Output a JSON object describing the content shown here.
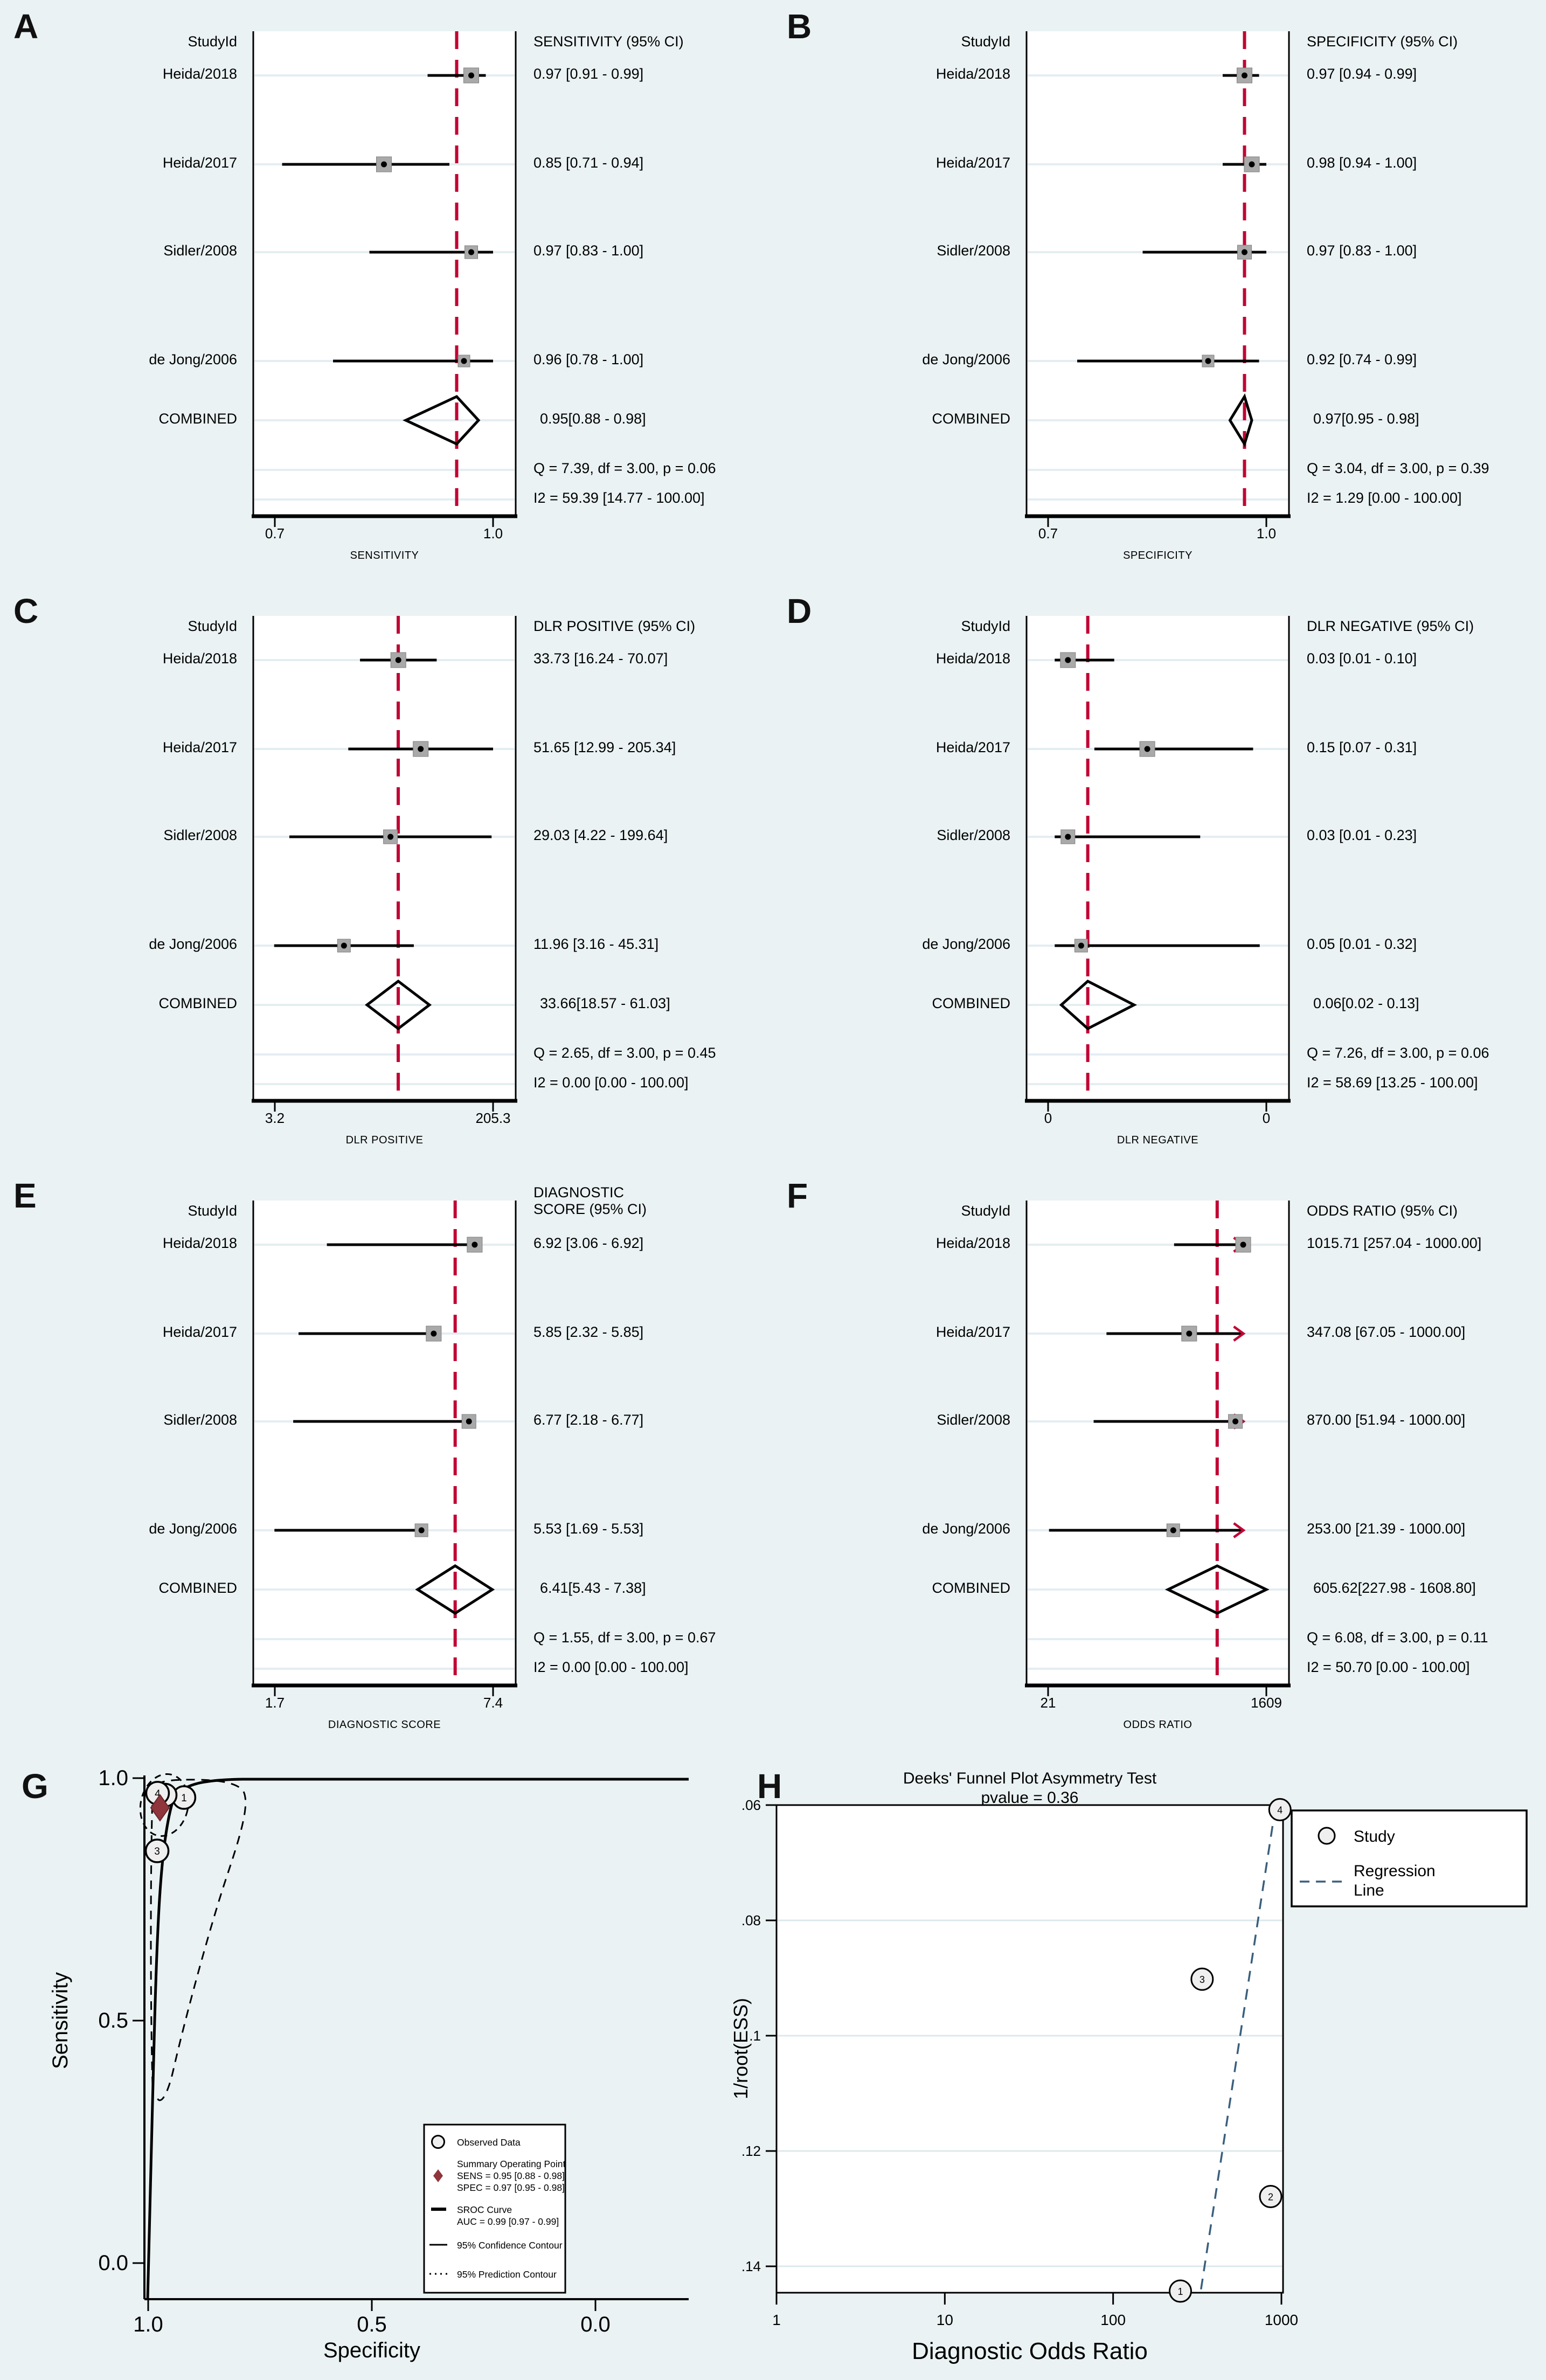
{
  "figure": {
    "background": "#eaf2f3",
    "plot_bg": "#ffffff",
    "ref_line_color": "#c10534",
    "marker_fill": "#a9a9a9",
    "marker_dot": "#000000",
    "diamond_stroke": "#000000",
    "summary_point_color": "#8f353b",
    "regression_color": "#3a5f7d",
    "grid_color": "#e4edf2"
  },
  "chart_data": [
    {
      "type": "forest",
      "letter": "A",
      "col_header": "StudyId",
      "value_header": "SENSITIVITY (95% CI)",
      "scale": "linear",
      "axis_lo": 0.7,
      "axis_hi": 1.0,
      "tick_lo_label": "0.7",
      "tick_hi_label": "1.0",
      "axis_title": "SENSITIVITY",
      "ref": 0.95,
      "arrows": false,
      "studies": [
        {
          "label": "Heida/2018",
          "text": "0.97 [0.91 - 0.99]",
          "est": 0.97,
          "lo": 0.91,
          "hi": 0.99,
          "w": 28
        },
        {
          "label": "Heida/2017",
          "text": "0.85 [0.71 - 0.94]",
          "est": 0.85,
          "lo": 0.71,
          "hi": 0.94,
          "w": 28
        },
        {
          "label": "Sidler/2008",
          "text": "0.97 [0.83 - 1.00]",
          "est": 0.97,
          "lo": 0.83,
          "hi": 1.0,
          "w": 24
        },
        {
          "label": "de Jong/2006",
          "text": "0.96 [0.78 - 1.00]",
          "est": 0.96,
          "lo": 0.78,
          "hi": 1.0,
          "w": 22
        }
      ],
      "combined": {
        "label": "COMBINED",
        "text": "0.95[0.88 - 0.98]",
        "est": 0.95,
        "lo": 0.88,
        "hi": 0.98
      },
      "q_text": "Q =  7.39, df = 3.00, p =  0.06",
      "i2_text": "I2 = 59.39 [14.77 - 100.00]"
    },
    {
      "type": "forest",
      "letter": "B",
      "col_header": "StudyId",
      "value_header": "SPECIFICITY (95% CI)",
      "scale": "linear",
      "axis_lo": 0.7,
      "axis_hi": 1.0,
      "tick_lo_label": "0.7",
      "tick_hi_label": "1.0",
      "axis_title": "SPECIFICITY",
      "ref": 0.97,
      "arrows": false,
      "studies": [
        {
          "label": "Heida/2018",
          "text": "0.97 [0.94 - 0.99]",
          "est": 0.97,
          "lo": 0.94,
          "hi": 0.99,
          "w": 28
        },
        {
          "label": "Heida/2017",
          "text": "0.98 [0.94 - 1.00]",
          "est": 0.98,
          "lo": 0.94,
          "hi": 1.0,
          "w": 28
        },
        {
          "label": "Sidler/2008",
          "text": "0.97 [0.83 - 1.00]",
          "est": 0.97,
          "lo": 0.83,
          "hi": 1.0,
          "w": 26
        },
        {
          "label": "de Jong/2006",
          "text": "0.92 [0.74 - 0.99]",
          "est": 0.92,
          "lo": 0.74,
          "hi": 0.99,
          "w": 22
        }
      ],
      "combined": {
        "label": "COMBINED",
        "text": "0.97[0.95 - 0.98]",
        "est": 0.97,
        "lo": 0.95,
        "hi": 0.98
      },
      "q_text": "Q =  3.04, df = 3.00, p =  0.39",
      "i2_text": "I2 = 1.29 [0.00 - 100.00]"
    },
    {
      "type": "forest",
      "letter": "C",
      "col_header": "StudyId",
      "value_header": "DLR POSITIVE (95% CI)",
      "scale": "log",
      "axis_lo": 3.2,
      "axis_hi": 205.3,
      "tick_lo_label": "3.2",
      "tick_hi_label": "205.3",
      "axis_title": "DLR POSITIVE",
      "ref": 33.66,
      "arrows": false,
      "studies": [
        {
          "label": "Heida/2018",
          "text": "33.73 [16.24 - 70.07]",
          "est": 33.73,
          "lo": 16.24,
          "hi": 70.07,
          "w": 28
        },
        {
          "label": "Heida/2017",
          "text": "51.65 [12.99 - 205.34]",
          "est": 51.65,
          "lo": 12.99,
          "hi": 205.34,
          "w": 28
        },
        {
          "label": "Sidler/2008",
          "text": "29.03 [4.22 - 199.64]",
          "est": 29.03,
          "lo": 4.22,
          "hi": 199.64,
          "w": 26
        },
        {
          "label": "de Jong/2006",
          "text": "11.96 [3.16 - 45.31]",
          "est": 11.96,
          "lo": 3.16,
          "hi": 45.31,
          "w": 24
        }
      ],
      "combined": {
        "label": "COMBINED",
        "text": "33.66[18.57 - 61.03]",
        "est": 33.66,
        "lo": 18.57,
        "hi": 61.03
      },
      "q_text": "Q =  2.65, df = 3.00, p =  0.45",
      "i2_text": "I2 = 0.00 [0.00 - 100.00]"
    },
    {
      "type": "forest",
      "letter": "D",
      "col_header": "StudyId",
      "value_header": "DLR NEGATIVE (95% CI)",
      "scale": "linear",
      "axis_lo": 0.0,
      "axis_hi": 0.33,
      "tick_lo_label": "0",
      "tick_hi_label": "0",
      "axis_title": "DLR NEGATIVE",
      "ref": 0.06,
      "arrows": false,
      "studies": [
        {
          "label": "Heida/2018",
          "text": "0.03 [0.01 - 0.10]",
          "est": 0.03,
          "lo": 0.01,
          "hi": 0.1,
          "w": 28
        },
        {
          "label": "Heida/2017",
          "text": "0.15 [0.07 - 0.31]",
          "est": 0.15,
          "lo": 0.07,
          "hi": 0.31,
          "w": 28
        },
        {
          "label": "Sidler/2008",
          "text": "0.03 [0.01 - 0.23]",
          "est": 0.03,
          "lo": 0.01,
          "hi": 0.23,
          "w": 26
        },
        {
          "label": "de Jong/2006",
          "text": "0.05 [0.01 - 0.32]",
          "est": 0.05,
          "lo": 0.01,
          "hi": 0.32,
          "w": 24
        }
      ],
      "combined": {
        "label": "COMBINED",
        "text": "0.06[0.02 - 0.13]",
        "est": 0.06,
        "lo": 0.02,
        "hi": 0.13
      },
      "q_text": "Q =  7.26, df = 3.00, p =  0.06",
      "i2_text": "I2 = 58.69 [13.25 - 100.00]"
    },
    {
      "type": "forest",
      "letter": "E",
      "col_header": "StudyId",
      "value_header": "DIAGNOSTIC\nSCORE (95% CI)",
      "scale": "linear",
      "axis_lo": 1.7,
      "axis_hi": 7.4,
      "tick_lo_label": "1.7",
      "tick_hi_label": "7.4",
      "axis_title": "DIAGNOSTIC SCORE",
      "ref": 6.41,
      "arrows": false,
      "studies": [
        {
          "label": "Heida/2018",
          "text": "6.92 [3.06 - 6.92]",
          "est": 6.92,
          "lo": 3.06,
          "hi": 6.92,
          "w": 28
        },
        {
          "label": "Heida/2017",
          "text": "5.85 [2.32 - 5.85]",
          "est": 5.85,
          "lo": 2.32,
          "hi": 5.85,
          "w": 28
        },
        {
          "label": "Sidler/2008",
          "text": "6.77 [2.18 - 6.77]",
          "est": 6.77,
          "lo": 2.18,
          "hi": 6.77,
          "w": 26
        },
        {
          "label": "de Jong/2006",
          "text": "5.53 [1.69 - 5.53]",
          "est": 5.53,
          "lo": 1.69,
          "hi": 5.53,
          "w": 24
        }
      ],
      "combined": {
        "label": "COMBINED",
        "text": "6.41[5.43 - 7.38]",
        "est": 6.41,
        "lo": 5.43,
        "hi": 7.38
      },
      "q_text": "Q =  1.55, df = 3.00, p =  0.67",
      "i2_text": "I2 = 0.00 [0.00 - 100.00]"
    },
    {
      "type": "forest",
      "letter": "F",
      "col_header": "StudyId",
      "value_header": "ODDS RATIO (95% CI)",
      "scale": "log",
      "axis_lo": 21,
      "axis_hi": 1609,
      "tick_lo_label": "21",
      "tick_hi_label": "1609",
      "axis_title": "ODDS RATIO",
      "ref": 605.62,
      "arrows": true,
      "arrow_at": 1000,
      "studies": [
        {
          "label": "Heida/2018",
          "text": "1015.71 [257.04 - 1000.00]",
          "est": 1015.71,
          "lo": 257.04,
          "hi": 1000,
          "w": 28
        },
        {
          "label": "Heida/2017",
          "text": "347.08 [67.05 - 1000.00]",
          "est": 347.08,
          "lo": 67.05,
          "hi": 1000,
          "w": 28
        },
        {
          "label": "Sidler/2008",
          "text": "870.00 [51.94 - 1000.00]",
          "est": 870.0,
          "lo": 51.94,
          "hi": 1000,
          "w": 26
        },
        {
          "label": "de Jong/2006",
          "text": "253.00 [21.39 - 1000.00]",
          "est": 253.0,
          "lo": 21.39,
          "hi": 1000,
          "w": 24
        }
      ],
      "combined": {
        "label": "COMBINED",
        "text": "605.62[227.98 - 1608.80]",
        "est": 605.62,
        "lo": 227.98,
        "hi": 1608.8
      },
      "q_text": "Q =  6.08, df = 3.00, p =  0.11",
      "i2_text": "I2 = 50.70 [0.00 - 100.00]"
    },
    {
      "type": "scatter",
      "letter": "G",
      "ylabel": "Sensitivity",
      "xlabel": "Specificity",
      "yticks": [
        "1.0",
        "0.5",
        "0.0"
      ],
      "xticks": [
        "1.0",
        "0.5",
        "0.0"
      ],
      "ylim": [
        0.0,
        1.0
      ],
      "xlim_reversed": [
        1.0,
        0.0
      ],
      "points": [
        {
          "n": "1",
          "spec": 0.92,
          "sens": 0.96
        },
        {
          "n": "2",
          "spec": 0.962,
          "sens": 0.965
        },
        {
          "n": "3",
          "spec": 0.98,
          "sens": 0.85
        },
        {
          "n": "4",
          "spec": 0.979,
          "sens": 0.969
        }
      ],
      "summary": {
        "sens": 0.95,
        "spec": 0.97
      },
      "legend": {
        "observed": "Observed Data",
        "summary_lines": [
          "Summary Operating Point",
          "SENS = 0.95 [0.88 - 0.98]",
          "SPEC = 0.97 [0.95 - 0.98]"
        ],
        "sroc_lines": [
          "SROC Curve",
          "AUC = 0.99 [0.97 - 0.99]"
        ],
        "conf": "95% Confidence Contour",
        "pred": "95% Prediction Contour"
      }
    },
    {
      "type": "scatter",
      "letter": "H",
      "title": "Deeks' Funnel Plot Asymmetry Test",
      "pvalue_text": "pvalue  =  0.36",
      "ylabel": "1/root(ESS)",
      "xlabel": "Diagnostic Odds Ratio",
      "yticks": [
        ".06",
        ".08",
        ".1",
        ".12",
        ".14"
      ],
      "xticks": [
        "1",
        "10",
        "100",
        "1000"
      ],
      "ylim": [
        0.06,
        0.145
      ],
      "xlim_log": [
        1,
        1000
      ],
      "points": [
        {
          "n": "1",
          "dor": 251,
          "y": 0.1443
        },
        {
          "n": "2",
          "dor": 863,
          "y": 0.1279
        },
        {
          "n": "3",
          "dor": 338,
          "y": 0.0902
        },
        {
          "n": "4",
          "dor": 980,
          "y": 0.0608
        }
      ],
      "regression": {
        "dor1": 920,
        "y1": 0.0605,
        "dor2": 330,
        "y2": 0.1447
      },
      "legend": {
        "study": "Study",
        "regression": [
          "Regression",
          "Line"
        ]
      }
    }
  ]
}
